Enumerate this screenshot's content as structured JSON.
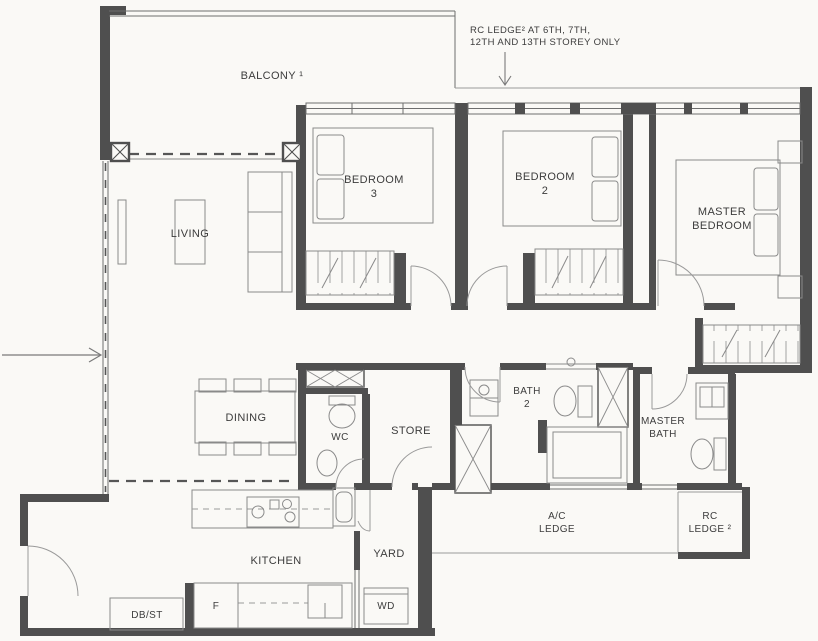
{
  "annotation": {
    "line1": "RC LEDGE² AT 6TH, 7TH,",
    "line2": "12TH AND 13TH STOREY ONLY"
  },
  "rooms": {
    "balcony": {
      "label": "BALCONY ¹"
    },
    "living": {
      "label": "LIVING"
    },
    "dining": {
      "label": "DINING"
    },
    "bedroom3": {
      "label_line1": "BEDROOM",
      "label_line2": "3"
    },
    "bedroom2": {
      "label_line1": "BEDROOM",
      "label_line2": "2"
    },
    "master_bedroom": {
      "label_line1": "MASTER",
      "label_line2": "BEDROOM"
    },
    "wc": {
      "label": "WC"
    },
    "store": {
      "label": "STORE"
    },
    "bath2": {
      "label_line1": "BATH",
      "label_line2": "2"
    },
    "master_bath": {
      "label_line1": "MASTER",
      "label_line2": "BATH"
    },
    "kitchen": {
      "label": "KITCHEN"
    },
    "yard": {
      "label": "YARD"
    },
    "ac_ledge": {
      "label_line1": "A/C",
      "label_line2": "LEDGE"
    },
    "rc_ledge": {
      "label_line1": "RC",
      "label_line2": "LEDGE ²"
    },
    "db_st": {
      "label": "DB/ST"
    },
    "fridge": {
      "label": "F"
    },
    "washer_dryer": {
      "label": "WD"
    }
  },
  "colors": {
    "wall": "#4f4f4f",
    "window": "#6e6e6e",
    "fixture": "#8a8a8a",
    "text": "#3c3c3c",
    "background": "#faf9f6"
  }
}
